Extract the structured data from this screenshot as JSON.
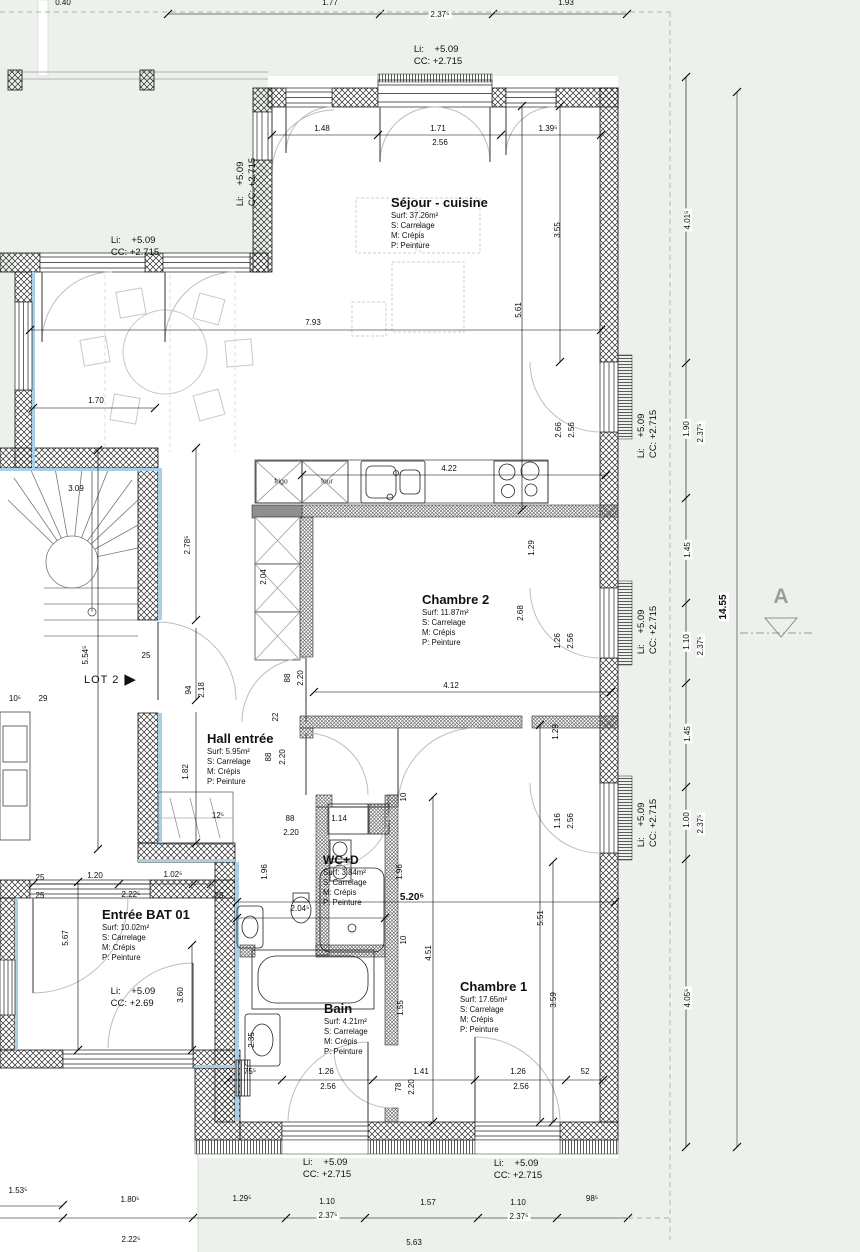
{
  "colors": {
    "background": "#ecf1eb",
    "wall_line": "#1a1a1a",
    "insulation": "#a9cfe6",
    "boundary": "#a9b4a9",
    "accent_gray": "#9a9f9a"
  },
  "markers": {
    "lot2": {
      "label": "LOT 2",
      "arrow": "▶"
    },
    "section_a": {
      "label": "A"
    },
    "overall_height": "14.55"
  },
  "kitchen": {
    "frigo": "frigo",
    "four": "four"
  },
  "rooms": [
    {
      "name": "sejour-cuisine",
      "title": "Séjour - cuisine",
      "surf": "Surf: 37.26m²",
      "s": "S: Carrelage",
      "m": "M: Crépis",
      "p": "P: Peinture",
      "x": 391,
      "y": 196,
      "ts": 13
    },
    {
      "name": "chambre-2",
      "title": "Chambre 2",
      "surf": "Surf: 11.87m²",
      "s": "S: Carrelage",
      "m": "M: Crépis",
      "p": "P: Peinture",
      "x": 422,
      "y": 593,
      "ts": 13
    },
    {
      "name": "hall-entree",
      "title": "Hall entrée",
      "surf": "Surf: 5.95m²",
      "s": "S: Carrelage",
      "m": "M: Crépis",
      "p": "P: Peinture",
      "x": 207,
      "y": 732,
      "ts": 13
    },
    {
      "name": "wc-d",
      "title": "WC+D",
      "surf": "Surf: 3.84m²",
      "s": "S: Carrelage",
      "m": "M: Crépis",
      "p": "P: Peinture",
      "x": 323,
      "y": 854,
      "ts": 12
    },
    {
      "name": "bain",
      "title": "Bain",
      "surf": "Surf: 4.21m²",
      "s": "S: Carrelage",
      "m": "M: Crépis",
      "p": "P: Peinture",
      "x": 324,
      "y": 1002,
      "ts": 13
    },
    {
      "name": "chambre-1",
      "title": "Chambre 1",
      "surf": "Surf: 17.65m²",
      "s": "S: Carrelage",
      "m": "M: Crépis",
      "p": "P: Peinture",
      "x": 460,
      "y": 980,
      "ts": 13
    },
    {
      "name": "entree-bat-01",
      "title": "Entrée BAT 01",
      "surf": "Surf: 10.02m²",
      "s": "S: Carrelage",
      "m": "M: Crépis",
      "p": "P: Peinture",
      "x": 102,
      "y": 908,
      "ts": 13
    }
  ],
  "levels": [
    {
      "li": "Li:    +5.09",
      "cc": "CC: +2.715",
      "x": 438,
      "y": 56,
      "r": 0
    },
    {
      "li": "Li:    +5.09",
      "cc": "CC: +2.715",
      "x": 135,
      "y": 247,
      "r": 0
    },
    {
      "li": "Li:    +5.09",
      "cc": "CC: +2.715",
      "x": 247,
      "y": 182,
      "r": 1
    },
    {
      "li": "Li:    +5.09",
      "cc": "CC: +2.715",
      "x": 648,
      "y": 434,
      "r": 1
    },
    {
      "li": "Li:    +5.09",
      "cc": "CC: +2.715",
      "x": 648,
      "y": 630,
      "r": 1
    },
    {
      "li": "Li:    +5.09",
      "cc": "CC: +2.715",
      "x": 648,
      "y": 823,
      "r": 1
    },
    {
      "li": "Li:    +5.09",
      "cc": "CC: +2.69",
      "x": 133,
      "y": 998,
      "r": 0
    },
    {
      "li": "Li:    +5.09",
      "cc": "CC: +2.715",
      "x": 327,
      "y": 1169,
      "r": 0
    },
    {
      "li": "Li:    +5.09",
      "cc": "CC: +2.715",
      "x": 518,
      "y": 1170,
      "r": 0
    }
  ],
  "dims": [
    {
      "t": "0.40",
      "x": 63,
      "y": 3
    },
    {
      "t": "1.77",
      "x": 330,
      "y": 3
    },
    {
      "t": "1.93",
      "x": 566,
      "y": 3
    },
    {
      "t": "2.37⁵",
      "x": 440,
      "y": 15,
      "chip": 1
    },
    {
      "t": "1.48",
      "x": 322,
      "y": 129
    },
    {
      "t": "1.71",
      "x": 438,
      "y": 129
    },
    {
      "t": "2.56",
      "x": 440,
      "y": 143,
      "chip": 1
    },
    {
      "t": "1.39⁵",
      "x": 548,
      "y": 129
    },
    {
      "t": "3.55",
      "x": 558,
      "y": 230,
      "r": 1
    },
    {
      "t": "5.61",
      "x": 519,
      "y": 310,
      "r": 1
    },
    {
      "t": "7.93",
      "x": 313,
      "y": 323
    },
    {
      "t": "1.70",
      "x": 96,
      "y": 401
    },
    {
      "t": "2.66",
      "x": 559,
      "y": 430,
      "r": 1
    },
    {
      "t": "2.56",
      "x": 572,
      "y": 430,
      "r": 1
    },
    {
      "t": "3.09",
      "x": 76,
      "y": 489
    },
    {
      "t": "2.78⁵",
      "x": 188,
      "y": 545,
      "r": 1
    },
    {
      "t": "2.04",
      "x": 264,
      "y": 577,
      "r": 1
    },
    {
      "t": "1.29",
      "x": 532,
      "y": 548,
      "r": 1
    },
    {
      "t": "2.68",
      "x": 521,
      "y": 613,
      "r": 1
    },
    {
      "t": "1.26",
      "x": 558,
      "y": 641,
      "r": 1
    },
    {
      "t": "2.56",
      "x": 571,
      "y": 641,
      "r": 1
    },
    {
      "t": "4.22",
      "x": 449,
      "y": 469
    },
    {
      "t": "5.54⁵",
      "x": 86,
      "y": 655,
      "r": 1
    },
    {
      "t": "25",
      "x": 146,
      "y": 656,
      "chip": 1
    },
    {
      "t": "94",
      "x": 189,
      "y": 690,
      "r": 1
    },
    {
      "t": "2.18",
      "x": 202,
      "y": 690,
      "r": 1
    },
    {
      "t": "88",
      "x": 288,
      "y": 678,
      "r": 1
    },
    {
      "t": "2.20",
      "x": 301,
      "y": 678,
      "r": 1
    },
    {
      "t": "4.12",
      "x": 451,
      "y": 686
    },
    {
      "t": "22",
      "x": 276,
      "y": 717,
      "r": 1
    },
    {
      "t": "1.29",
      "x": 556,
      "y": 732,
      "r": 1
    },
    {
      "t": "88",
      "x": 269,
      "y": 757,
      "r": 1
    },
    {
      "t": "2.20",
      "x": 283,
      "y": 757,
      "r": 1
    },
    {
      "t": "1.82",
      "x": 186,
      "y": 772,
      "r": 1
    },
    {
      "t": "10⁵",
      "x": 15,
      "y": 699
    },
    {
      "t": "29",
      "x": 43,
      "y": 699
    },
    {
      "t": "12⁵",
      "x": 218,
      "y": 816
    },
    {
      "t": "88",
      "x": 290,
      "y": 819
    },
    {
      "t": "2.20",
      "x": 291,
      "y": 833
    },
    {
      "t": "1.14",
      "x": 339,
      "y": 819
    },
    {
      "t": "1.96",
      "x": 265,
      "y": 872,
      "r": 1
    },
    {
      "t": "1.96",
      "x": 400,
      "y": 872,
      "r": 1
    },
    {
      "t": "1.16",
      "x": 558,
      "y": 821,
      "r": 1
    },
    {
      "t": "2.56",
      "x": 571,
      "y": 821,
      "r": 1
    },
    {
      "t": "5.20⁵",
      "x": 412,
      "y": 898,
      "b": 1
    },
    {
      "t": "2.04⁵",
      "x": 300,
      "y": 909
    },
    {
      "t": "1.20",
      "x": 95,
      "y": 876
    },
    {
      "t": "1.02⁵",
      "x": 173,
      "y": 875
    },
    {
      "t": "25",
      "x": 40,
      "y": 878
    },
    {
      "t": "2.22⁵",
      "x": 131,
      "y": 895
    },
    {
      "t": "25",
      "x": 40,
      "y": 896
    },
    {
      "t": "25",
      "x": 219,
      "y": 896
    },
    {
      "t": "5.67",
      "x": 66,
      "y": 938,
      "r": 1
    },
    {
      "t": "10",
      "x": 404,
      "y": 797,
      "r": 1
    },
    {
      "t": "10",
      "x": 404,
      "y": 940,
      "r": 1
    },
    {
      "t": "4.51",
      "x": 429,
      "y": 953,
      "r": 1
    },
    {
      "t": "5.51",
      "x": 541,
      "y": 918,
      "r": 1
    },
    {
      "t": "1.55",
      "x": 401,
      "y": 1008,
      "r": 1
    },
    {
      "t": "3.59",
      "x": 554,
      "y": 1000,
      "r": 1
    },
    {
      "t": "3.60",
      "x": 181,
      "y": 995,
      "r": 1
    },
    {
      "t": "2.35",
      "x": 252,
      "y": 1040,
      "r": 1
    },
    {
      "t": "75⁵",
      "x": 250,
      "y": 1072
    },
    {
      "t": "1.26",
      "x": 326,
      "y": 1072
    },
    {
      "t": "2.56",
      "x": 328,
      "y": 1087
    },
    {
      "t": "78",
      "x": 399,
      "y": 1087,
      "r": 1
    },
    {
      "t": "2.20",
      "x": 412,
      "y": 1087,
      "r": 1
    },
    {
      "t": "1.41",
      "x": 421,
      "y": 1072
    },
    {
      "t": "1.26",
      "x": 518,
      "y": 1072
    },
    {
      "t": "2.56",
      "x": 521,
      "y": 1087
    },
    {
      "t": "52",
      "x": 585,
      "y": 1072
    },
    {
      "t": "4.01⁵",
      "x": 688,
      "y": 220,
      "r": 1,
      "chip": 1
    },
    {
      "t": "1.90",
      "x": 687,
      "y": 429,
      "r": 1,
      "chip": 1
    },
    {
      "t": "2.37⁵",
      "x": 701,
      "y": 433,
      "r": 1,
      "chip": 1
    },
    {
      "t": "1.45",
      "x": 688,
      "y": 550,
      "r": 1,
      "chip": 1
    },
    {
      "t": "1.10",
      "x": 687,
      "y": 642,
      "r": 1,
      "chip": 1
    },
    {
      "t": "2.37⁵",
      "x": 701,
      "y": 646,
      "r": 1,
      "chip": 1
    },
    {
      "t": "1.45",
      "x": 688,
      "y": 734,
      "r": 1,
      "chip": 1
    },
    {
      "t": "1.00",
      "x": 687,
      "y": 820,
      "r": 1,
      "chip": 1
    },
    {
      "t": "2.37⁵",
      "x": 701,
      "y": 824,
      "r": 1,
      "chip": 1
    },
    {
      "t": "4.05⁵",
      "x": 688,
      "y": 998,
      "r": 1,
      "chip": 1
    },
    {
      "t": "14.55",
      "x": 724,
      "y": 607,
      "r": 1,
      "b": 1,
      "chip": 1
    },
    {
      "t": "1.53⁵",
      "x": 18,
      "y": 1191
    },
    {
      "t": "1.80⁵",
      "x": 130,
      "y": 1200
    },
    {
      "t": "1.29⁵",
      "x": 242,
      "y": 1199
    },
    {
      "t": "1.10",
      "x": 327,
      "y": 1202
    },
    {
      "t": "2.37⁵",
      "x": 328,
      "y": 1216,
      "chip": 1
    },
    {
      "t": "1.57",
      "x": 428,
      "y": 1203
    },
    {
      "t": "1.10",
      "x": 518,
      "y": 1203
    },
    {
      "t": "2.37⁵",
      "x": 519,
      "y": 1217,
      "chip": 1
    },
    {
      "t": "98⁵",
      "x": 592,
      "y": 1199
    },
    {
      "t": "2.22⁵",
      "x": 131,
      "y": 1240
    },
    {
      "t": "5.63",
      "x": 414,
      "y": 1243
    }
  ]
}
